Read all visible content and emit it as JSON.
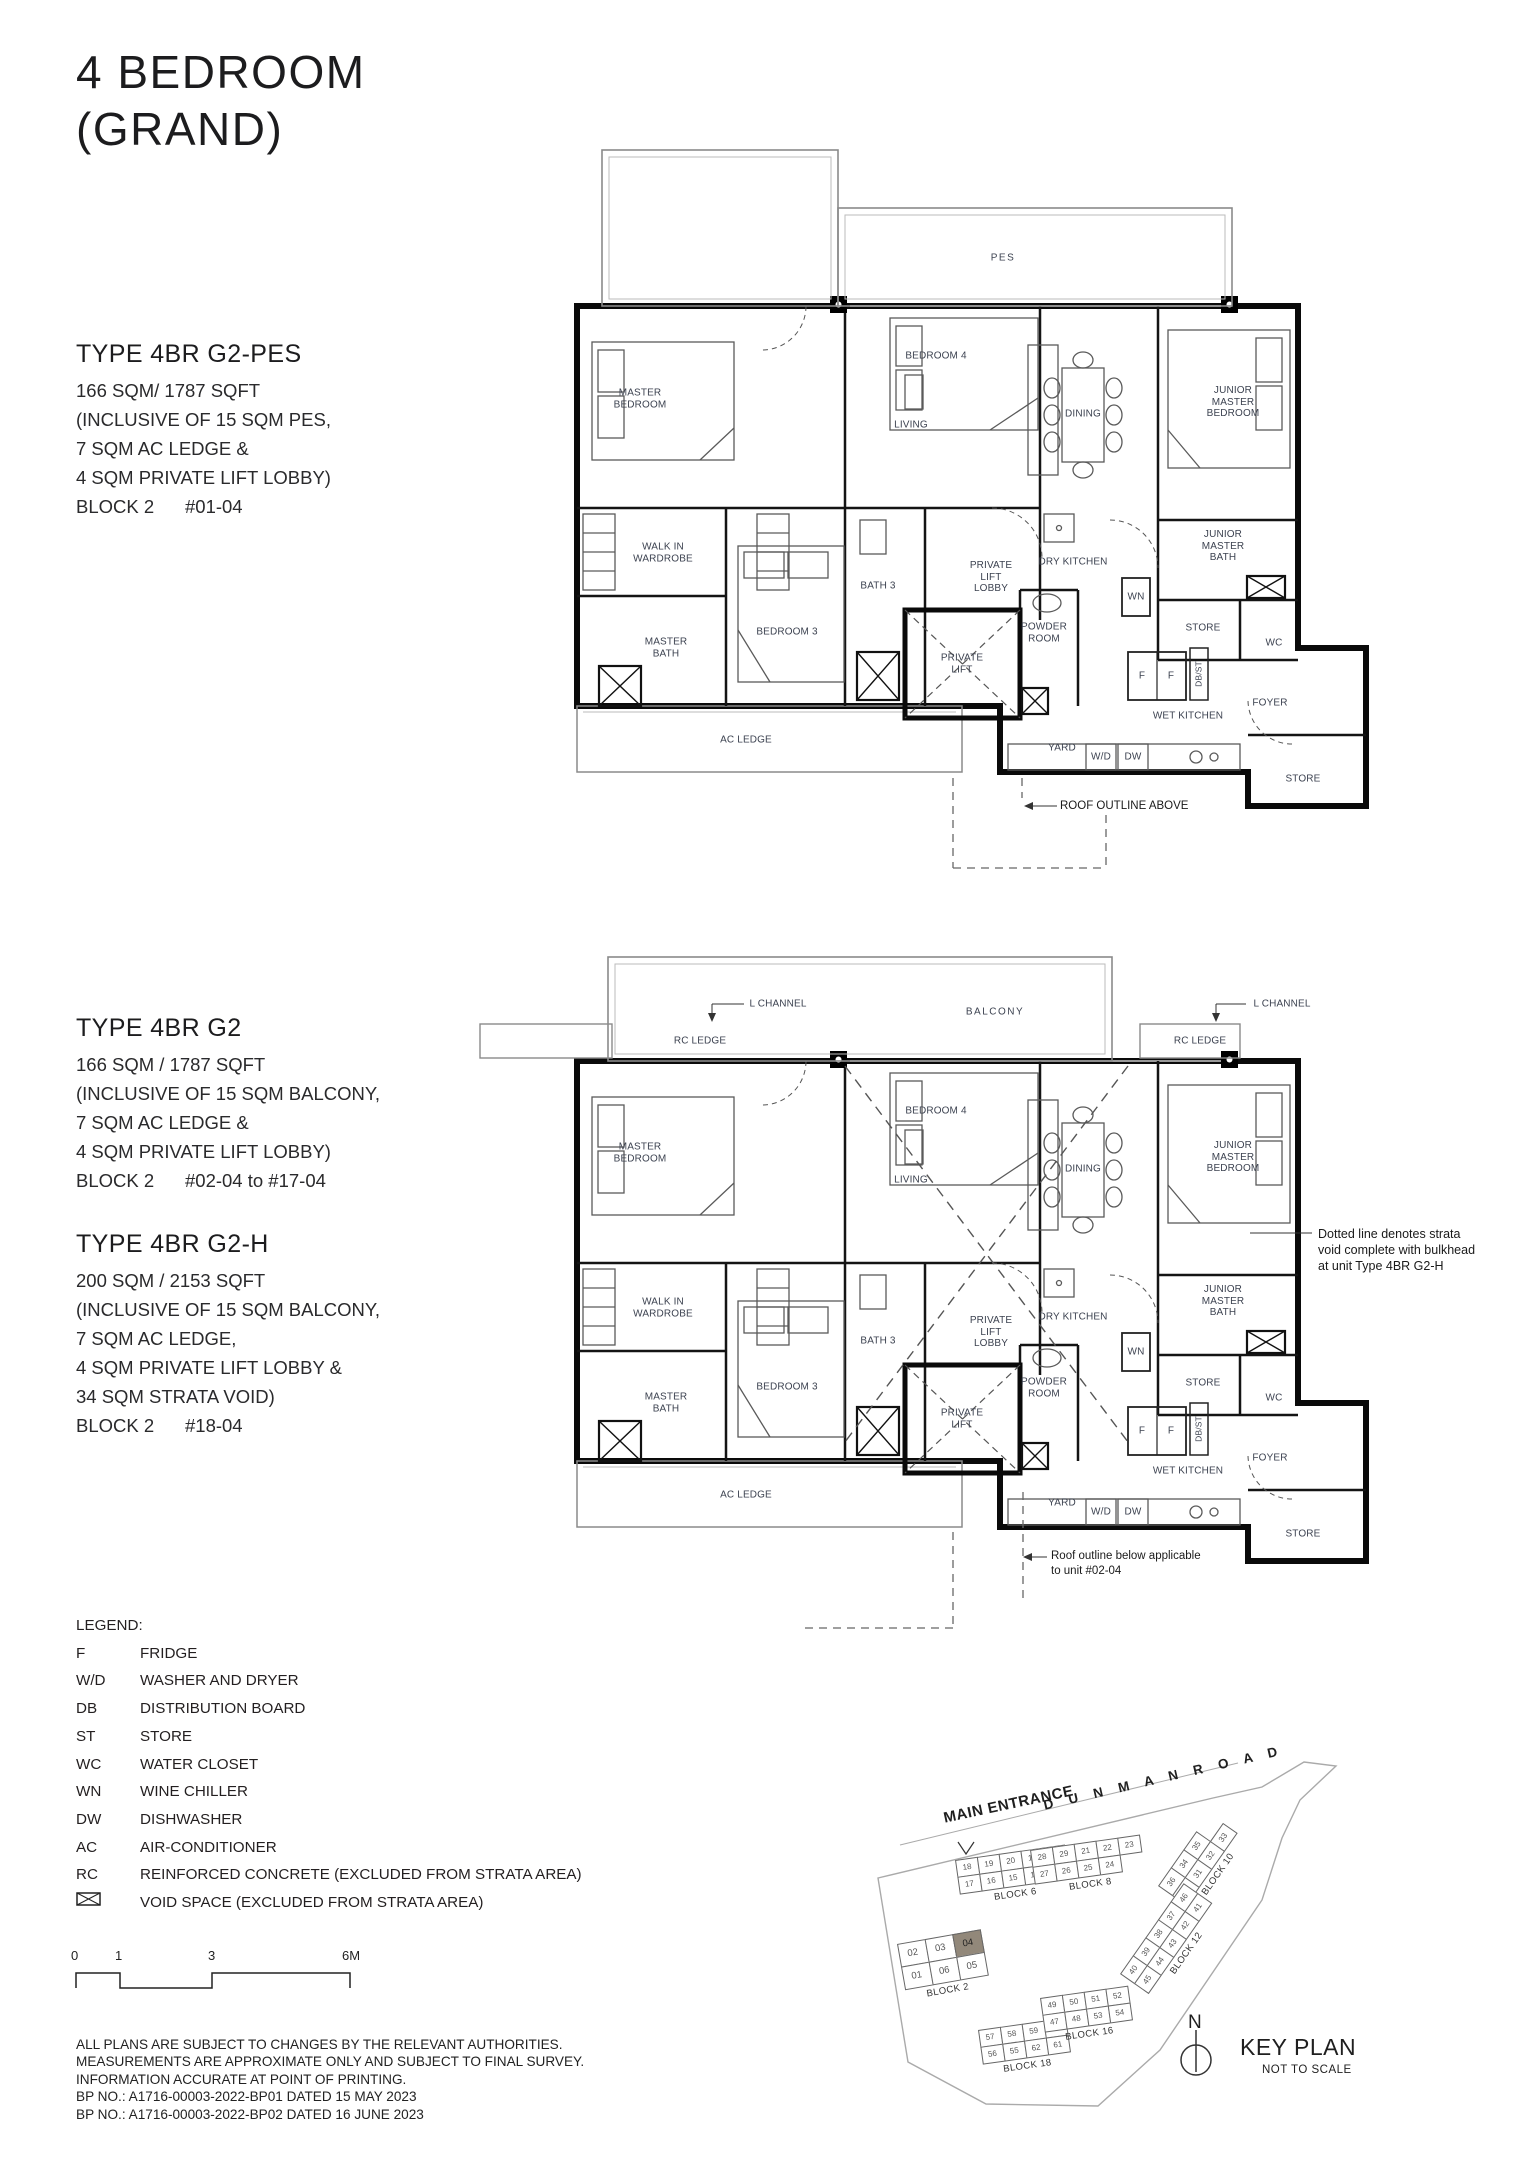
{
  "header": {
    "title": "4 BEDROOM\n(GRAND)"
  },
  "types": [
    {
      "name": "TYPE 4BR G2-PES",
      "lines": [
        "166 SQM/ 1787 SQFT",
        "(INCLUSIVE OF 15 SQM PES,",
        "7 SQM AC LEDGE &",
        "4 SQM PRIVATE LIFT LOBBY)",
        "BLOCK 2      #01-04"
      ]
    },
    {
      "name": "TYPE 4BR G2",
      "lines": [
        "166 SQM / 1787 SQFT",
        "(INCLUSIVE OF 15 SQM BALCONY,",
        "7 SQM AC LEDGE &",
        "4 SQM PRIVATE LIFT LOBBY)",
        "BLOCK 2      #02-04 to #17-04"
      ]
    },
    {
      "name": "TYPE 4BR G2-H",
      "lines": [
        "200 SQM / 2153 SQFT",
        "(INCLUSIVE OF 15 SQM BALCONY,",
        "7 SQM AC LEDGE,",
        "4 SQM PRIVATE LIFT LOBBY &",
        "34 SQM STRATA VOID)",
        "BLOCK 2      #18-04"
      ]
    }
  ],
  "plan_pes": {
    "rooms": {
      "pes": "PES",
      "master_bedroom": "MASTER\nBEDROOM",
      "bedroom_4": "BEDROOM 4",
      "living": "LIVING",
      "dining": "DINING",
      "junior_master_bedroom": "JUNIOR\nMASTER\nBEDROOM",
      "walk_in_wardrobe": "WALK IN\nWARDROBE",
      "bath_3": "BATH 3",
      "private_lift_lobby": "PRIVATE\nLIFT\nLOBBY",
      "dry_kitchen": "DRY KITCHEN",
      "master_bath": "MASTER\nBATH",
      "bedroom_3": "BEDROOM 3",
      "private_lift": "PRIVATE\nLIFT",
      "powder_room": "POWDER\nROOM",
      "junior_master_bath": "JUNIOR\nMASTER\nBATH",
      "wn": "WN",
      "store": "STORE",
      "wc": "WC",
      "f": "F",
      "db_st": "DB/ST",
      "foyer": "FOYER",
      "wet_kitchen": "WET KITCHEN",
      "yard": "YARD",
      "wd": "W/D",
      "dw": "DW",
      "store_rear": "STORE",
      "ac_ledge": "AC LEDGE"
    },
    "note_roof": "ROOF OUTLINE ABOVE"
  },
  "plan_g2": {
    "rooms": {
      "balcony": "BALCONY",
      "l_channel": "L CHANNEL",
      "rc_ledge": "RC LEDGE",
      "master_bedroom": "MASTER\nBEDROOM",
      "bedroom_4": "BEDROOM 4",
      "living": "LIVING",
      "dining": "DINING",
      "junior_master_bedroom": "JUNIOR\nMASTER\nBEDROOM",
      "walk_in_wardrobe": "WALK IN\nWARDROBE",
      "bath_3": "BATH 3",
      "private_lift_lobby": "PRIVATE\nLIFT\nLOBBY",
      "dry_kitchen": "DRY KITCHEN",
      "master_bath": "MASTER\nBATH",
      "bedroom_3": "BEDROOM 3",
      "private_lift": "PRIVATE\nLIFT",
      "powder_room": "POWDER\nROOM",
      "junior_master_bath": "JUNIOR\nMASTER\nBATH",
      "wn": "WN",
      "store": "STORE",
      "wc": "WC",
      "f": "F",
      "db_st": "DB/ST",
      "foyer": "FOYER",
      "wet_kitchen": "WET KITCHEN",
      "yard": "YARD",
      "wd": "W/D",
      "dw": "DW",
      "store_rear": "STORE",
      "ac_ledge": "AC LEDGE"
    },
    "note_strata": "Dotted line denotes strata\nvoid complete with bulkhead\nat unit Type 4BR G2-H",
    "note_roof": "Roof outline below applicable\nto unit #02-04"
  },
  "legend": {
    "title": "LEGEND:",
    "items": [
      {
        "abbr": "F",
        "desc": "FRIDGE"
      },
      {
        "abbr": "W/D",
        "desc": "WASHER AND DRYER"
      },
      {
        "abbr": "DB",
        "desc": "DISTRIBUTION BOARD"
      },
      {
        "abbr": "ST",
        "desc": "STORE"
      },
      {
        "abbr": "WC",
        "desc": "WATER CLOSET"
      },
      {
        "abbr": "WN",
        "desc": "WINE CHILLER"
      },
      {
        "abbr": "DW",
        "desc": "DISHWASHER"
      },
      {
        "abbr": "AC",
        "desc": "AIR-CONDITIONER"
      },
      {
        "abbr": "RC",
        "desc": "REINFORCED CONCRETE (EXCLUDED FROM STRATA AREA)"
      }
    ],
    "void_desc": "VOID SPACE (EXCLUDED FROM STRATA AREA)"
  },
  "scalebar": {
    "ticks": [
      "0",
      "1",
      "3",
      "6M"
    ]
  },
  "disclaimer": [
    "ALL PLANS ARE SUBJECT TO CHANGES BY THE RELEVANT AUTHORITIES.",
    "MEASUREMENTS ARE APPROXIMATE ONLY AND SUBJECT TO FINAL SURVEY.",
    "INFORMATION ACCURATE AT POINT OF PRINTING.",
    "BP NO.: A1716-00003-2022-BP01 DATED 15 MAY 2023",
    "BP NO.: A1716-00003-2022-BP02 DATED 16 JUNE 2023"
  ],
  "keyplan": {
    "road_label": "D U N M A N    R O A D",
    "main_entrance": "MAIN ENTRANCE",
    "north": "N",
    "title": "KEY PLAN",
    "subtitle": "NOT TO SCALE",
    "highlight_unit": "04",
    "highlight_block": "BLOCK 2",
    "highlight_color": "#92887a",
    "clusters": [
      {
        "label": "BLOCK 6",
        "x": 955,
        "y": 1860,
        "angle": -8,
        "rows": [
          [
            "18",
            "19",
            "20",
            "12",
            "13"
          ],
          [
            "17",
            "16",
            "15",
            "14"
          ]
        ]
      },
      {
        "label": "BLOCK 8",
        "x": 1030,
        "y": 1850,
        "angle": -8,
        "rows": [
          [
            "28",
            "29",
            "21",
            "22",
            "23"
          ],
          [
            "27",
            "26",
            "25",
            "24"
          ]
        ]
      },
      {
        "label": "BLOCK 10",
        "x": 1158,
        "y": 1886,
        "angle": -55,
        "rows": [
          [
            "36",
            "34",
            "35"
          ],
          [
            "30",
            "31",
            "32",
            "33"
          ]
        ]
      },
      {
        "label": "BLOCK 12",
        "x": 1120,
        "y": 1974,
        "angle": -55,
        "rows": [
          [
            "40",
            "39",
            "38",
            "37",
            "46"
          ],
          [
            "45",
            "44",
            "43",
            "42",
            "41"
          ]
        ]
      },
      {
        "label": "BLOCK 2",
        "x": 897,
        "y": 1944,
        "angle": -10,
        "big": true,
        "rows": [
          [
            "02",
            "03",
            "04"
          ],
          [
            "01",
            "06",
            "05"
          ]
        ]
      },
      {
        "label": "BLOCK 18",
        "x": 978,
        "y": 2030,
        "angle": -8,
        "rows": [
          [
            "57",
            "58",
            "59",
            "60"
          ],
          [
            "56",
            "55",
            "62",
            "61"
          ]
        ]
      },
      {
        "label": "BLOCK 16",
        "x": 1040,
        "y": 1998,
        "angle": -8,
        "rows": [
          [
            "49",
            "50",
            "51",
            "52"
          ],
          [
            "47",
            "48",
            "53",
            "54"
          ]
        ]
      }
    ]
  }
}
